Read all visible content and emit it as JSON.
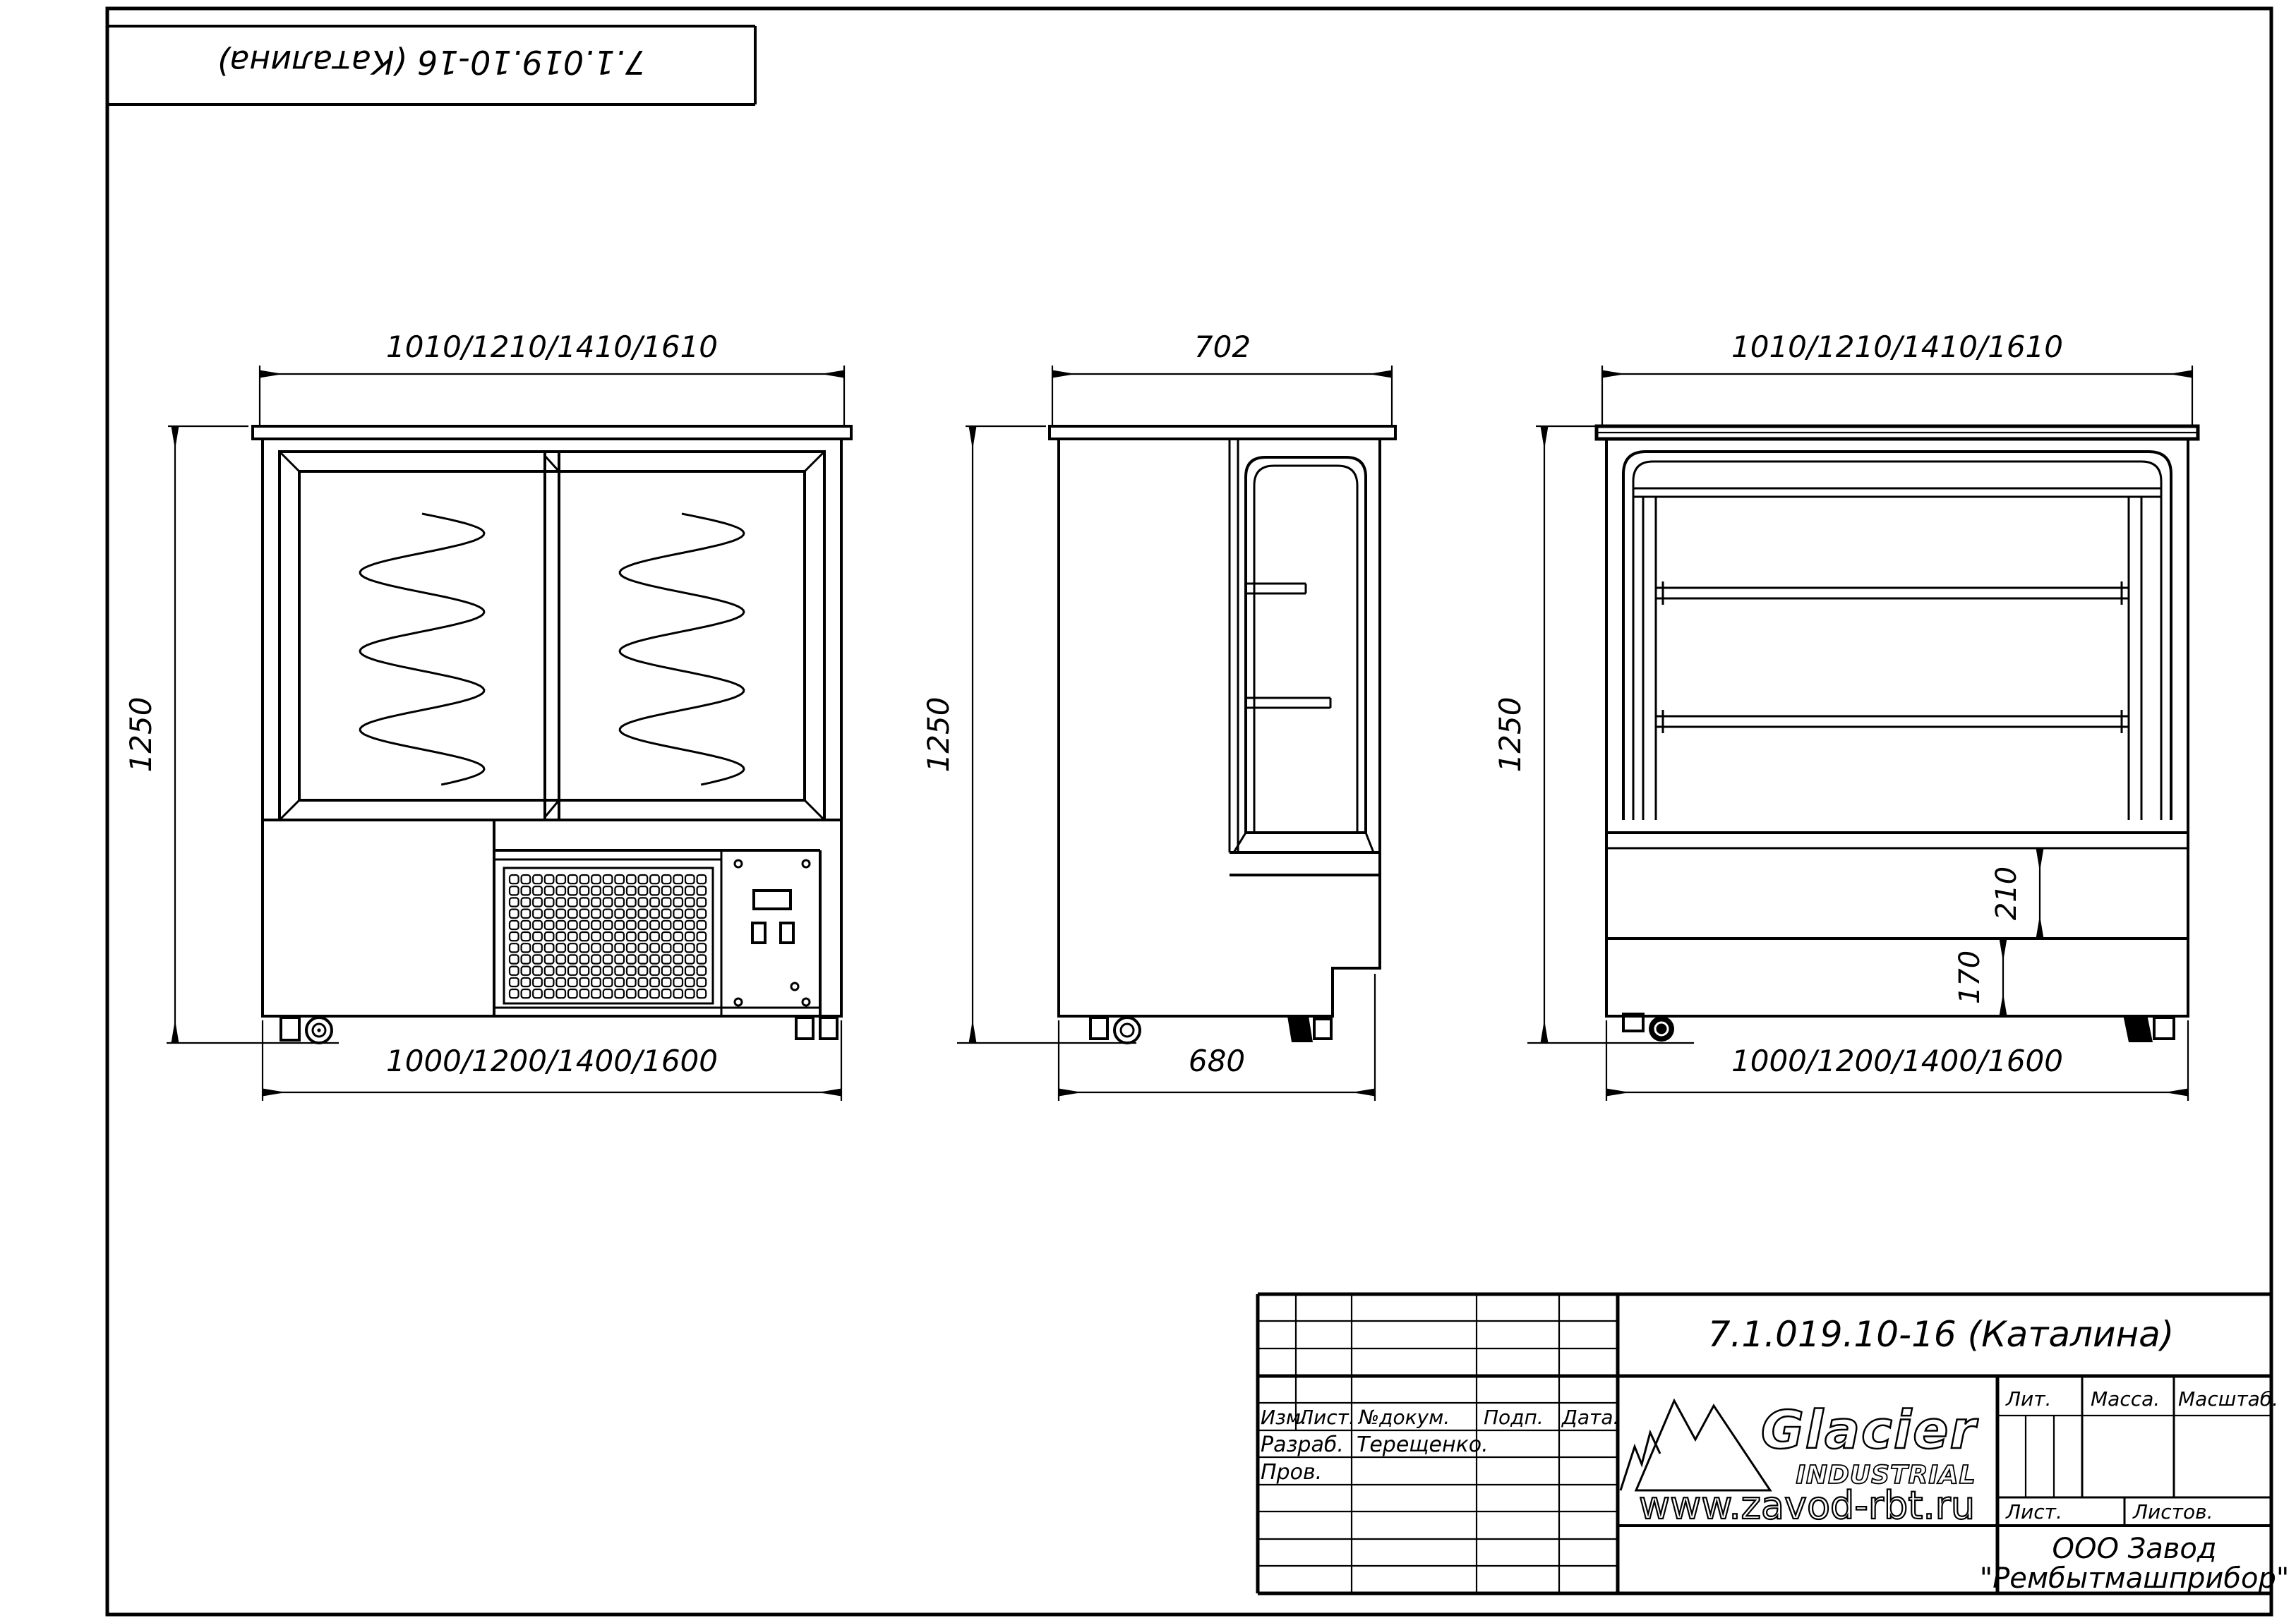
{
  "sheet": {
    "designation_top": "7.1.019.10-16  (Каталина)"
  },
  "views": {
    "front": {
      "width_top": "1010/1210/1410/1610",
      "height": "1250",
      "width_bottom": "1000/1200/1400/1600"
    },
    "side": {
      "depth_top": "702",
      "height": "1250",
      "depth_bottom": "680"
    },
    "rear": {
      "width_top": "1010/1210/1410/1610",
      "height": "1250",
      "base_upper": "210",
      "base_lower": "170",
      "width_bottom": "1000/1200/1400/1600"
    }
  },
  "title_block": {
    "designation": "7.1.019.10-16  (Каталина)",
    "header": {
      "izm": "Изм.",
      "list": "Лист.",
      "doc": "№докум.",
      "sign": "Подп.",
      "date": "Дата."
    },
    "roles": {
      "developed": "Разраб.",
      "developed_by": "Терещенко.",
      "checked": "Пров."
    },
    "props": {
      "lit": "Лит.",
      "mass": "Масса.",
      "scale": "Масштаб.",
      "sheet": "Лист.",
      "sheets": "Листов."
    },
    "company": [
      "ООО Завод",
      "\"Рембытмашприбор\""
    ],
    "logo": {
      "brand": "Glacier",
      "tagline": "INDUSTRIAL",
      "website": "www.zavod-rbt.ru"
    }
  }
}
